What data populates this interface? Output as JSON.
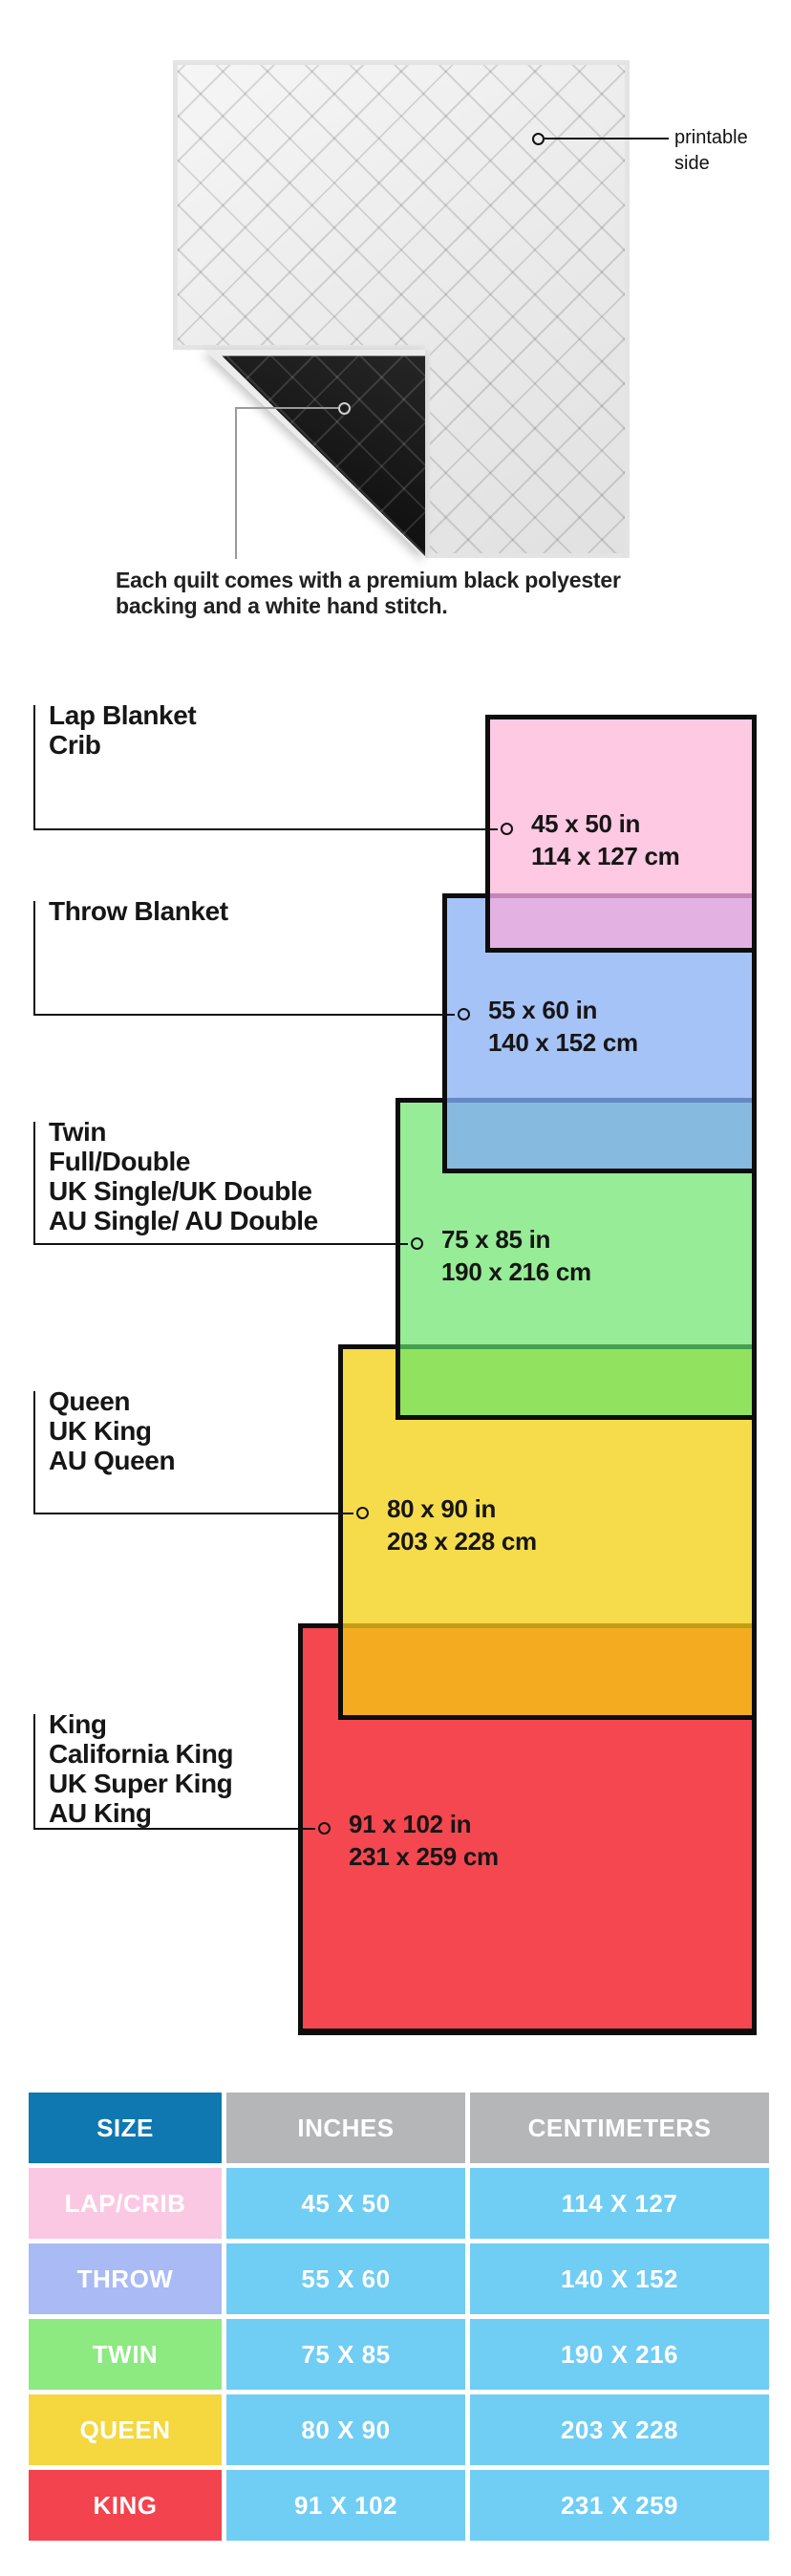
{
  "hero": {
    "printable_label": [
      "printable",
      "side"
    ],
    "caption": [
      "Each quilt comes with a premium black polyester",
      "backing and a white hand stitch."
    ],
    "front_color": "#f6f6f6",
    "back_color": "#181818"
  },
  "diagram": {
    "sizes": [
      {
        "key": "lap",
        "names": [
          "Lap Blanket",
          "Crib"
        ],
        "inches": "45 x 50 in",
        "centimeters": "114 x 127 cm",
        "fill": "#fdc9e3"
      },
      {
        "key": "throw",
        "names": [
          "Throw Blanket"
        ],
        "inches": "55 x 60 in",
        "centimeters": "140 x 152 cm",
        "fill": "#a6c3f8"
      },
      {
        "key": "twin",
        "names": [
          "Twin",
          "Full/Double",
          "UK Single/UK Double",
          "AU Single/ AU Double"
        ],
        "inches": "75 x 85 in",
        "centimeters": "190 x 216 cm",
        "fill": "#97ec97"
      },
      {
        "key": "queen",
        "names": [
          "Queen",
          "UK King",
          "AU Queen"
        ],
        "inches": "80 x 90 in",
        "centimeters": "203 x 228 cm",
        "fill": "#f6dc4b"
      },
      {
        "key": "king",
        "names": [
          "King",
          "California King",
          "UK Super King",
          "AU King"
        ],
        "inches": "91 x 102 in",
        "centimeters": "231 x 259 cm",
        "fill": "#f4474f"
      }
    ],
    "overlap_colors": {
      "pink_over_blue": "#e3b2e3",
      "blue_over_green": "#86bade",
      "green_over_yellow": "#90e25f",
      "yellow_over_red": "#f4ab20"
    },
    "border_color": "#0d0d0d"
  },
  "table": {
    "headers": [
      "SIZE",
      "INCHES",
      "CENTIMETERS"
    ],
    "header_size_color": "#0f78b1",
    "header_gray_color": "#b5b6b8",
    "data_cell_color": "#70cdf4",
    "rows": [
      {
        "size": "LAP/CRIB",
        "inches": "45 X 50",
        "centimeters": "114 X 127",
        "color": "#fbc8e3"
      },
      {
        "size": "THROW",
        "inches": "55 X 60",
        "centimeters": "140 X 152",
        "color": "#a9baf5"
      },
      {
        "size": "TWIN",
        "inches": "75 X 85",
        "centimeters": "190 X 216",
        "color": "#8cea81"
      },
      {
        "size": "QUEEN",
        "inches": "80 X 90",
        "centimeters": "203 X 228",
        "color": "#f5d73f"
      },
      {
        "size": "KING",
        "inches": "91 X 102",
        "centimeters": "231 X 259",
        "color": "#f2434e"
      }
    ]
  }
}
